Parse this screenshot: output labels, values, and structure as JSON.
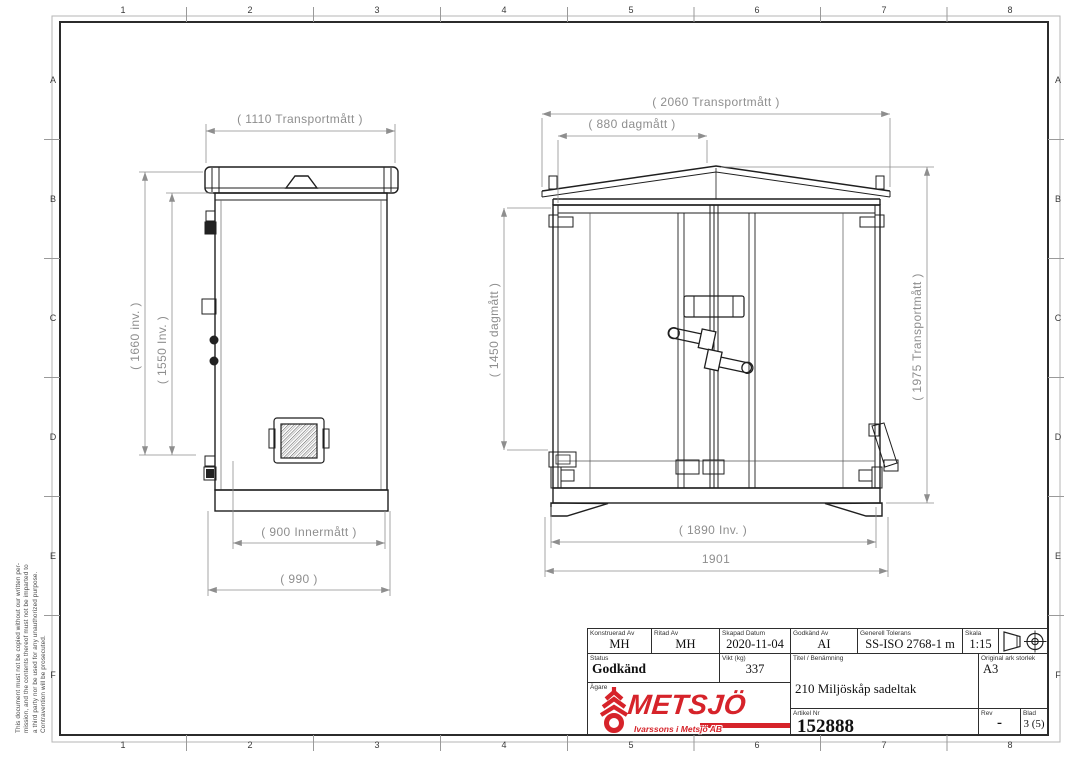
{
  "sheet": {
    "columns": [
      "1",
      "2",
      "3",
      "4",
      "5",
      "6",
      "7",
      "8"
    ],
    "rows": [
      "A",
      "B",
      "C",
      "D",
      "E",
      "F"
    ],
    "disclaimer": [
      "This document must not be copied without our written per-",
      "mission, and the contents thereof must not be imparted to",
      "a third party nor be used for any unauthorized purpose.",
      "Contravention will be prosecuted."
    ]
  },
  "drawing": {
    "side_view": {
      "dim_width_transport": "( 1110 Transportmått )",
      "dim_height_outer": "( 1660 inv. )",
      "dim_height_inner": "( 1550 Inv. )",
      "dim_width_inner": "( 900 Innermått )",
      "dim_width_base": "( 990 )"
    },
    "front_view": {
      "dim_width_transport": "( 2060 Transportmått )",
      "dim_width_daylight": "( 880 dagmått )",
      "dim_height_daylight": "( 1450 dagmått )",
      "dim_height_transport": "( 1975 Transportmått )",
      "dim_width_inner": "( 1890 Inv. )",
      "dim_width_outer": "1901"
    }
  },
  "title_block": {
    "designed": {
      "label": "Konstruerad Av",
      "value": "MH"
    },
    "drawn": {
      "label": "Ritad Av",
      "value": "MH"
    },
    "created": {
      "label": "Skapad Datum",
      "value": "2020-11-04"
    },
    "approved": {
      "label": "Godkänd Av",
      "value": "AI"
    },
    "tolerance": {
      "label": "Generell Tolerans",
      "value": "SS-ISO 2768-1 m"
    },
    "scale": {
      "label": "Skala",
      "value": "1:15"
    },
    "status": {
      "label": "Status",
      "value": "Godkänd"
    },
    "weight": {
      "label": "Vikt (kg)",
      "value": "337"
    },
    "title": {
      "label": "Titel / Benämning",
      "value": "210 Miljöskåp sadeltak"
    },
    "sheet_size": {
      "label": "Original ark storlek",
      "value": "A3"
    },
    "owner": {
      "label": "Ägare"
    },
    "article": {
      "label": "Artikel Nr",
      "value": "152888"
    },
    "rev": {
      "label": "Rev",
      "value": "-"
    },
    "page": {
      "label": "Blad",
      "value": "3 (5)"
    }
  },
  "logo": {
    "name": "METSJÖ",
    "subtitle": "Ivarssons i Metsjö AB",
    "color": "#d6232a"
  }
}
